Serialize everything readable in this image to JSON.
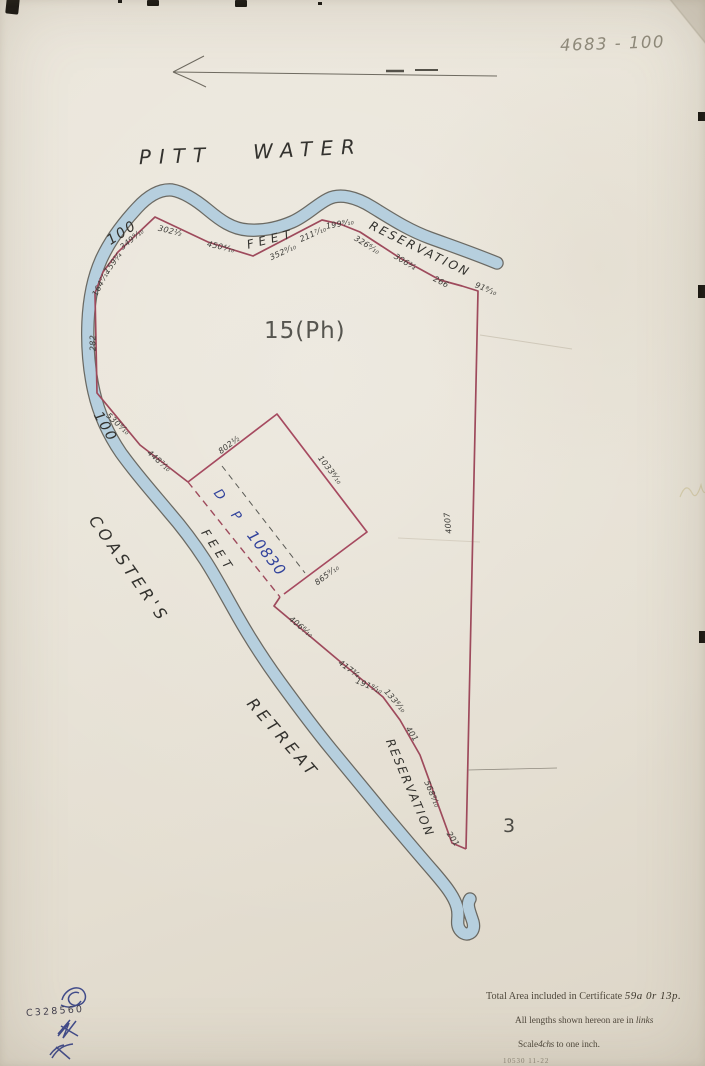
{
  "page": {
    "reference_number": "4683 - 100"
  },
  "map": {
    "water_name_word1": "PITT",
    "water_name_word2": "WATER",
    "parcel_label": "15(Ph)",
    "adjoining_lot_label": "3",
    "deposited_plan": {
      "d": "D",
      "p": "P",
      "number": "10830"
    },
    "place_name_word1": "COASTER'S",
    "place_name_word2": "RETREAT",
    "reservation_top": {
      "width": "100",
      "feet": "FEET",
      "word": "RESERVATION"
    },
    "reservation_west": {
      "width": "100",
      "feet": "FEET"
    },
    "reservation_lower_word": "RESERVATION",
    "measurements": [
      "302½",
      "450⁴⁄₁₀",
      "352⁹⁄₁₀",
      "211⁷⁄₁₀",
      "199⁹⁄₁₀",
      "326⁶⁄₁₀",
      "306¾",
      "266",
      "91⁸⁄₁₀",
      "349⁹⁄₁₀",
      "159¾",
      "164⁷⁄₁₀",
      "282",
      "530⁹⁄₁₀",
      "448⁷⁄₁₀",
      "802½",
      "1033⁶⁄₁₀",
      "865⁹⁄₁₀",
      "4007",
      "406⁶⁄₁₀",
      "417¾",
      "191⁹⁄₁₀",
      "133⁸⁄₁₀",
      "401",
      "568⁸⁄₁₀",
      "201"
    ],
    "colors": {
      "boundary_red": "#9e4a5c",
      "water_blue": "#b9d3e2",
      "ink_blue": "#32439c"
    }
  },
  "notes": {
    "total_area_prefix": "Total Area included in Certificate",
    "total_area_value": "59a 0r 13p.",
    "lengths_prefix": "All lengths shown hereon are in",
    "lengths_unit": "links",
    "scale_prefix": "Scale",
    "scale_value": "4chs",
    "scale_suffix": "to one inch.",
    "print_code": "10530   11-22"
  },
  "stamps": {
    "file_number": "C328560"
  }
}
